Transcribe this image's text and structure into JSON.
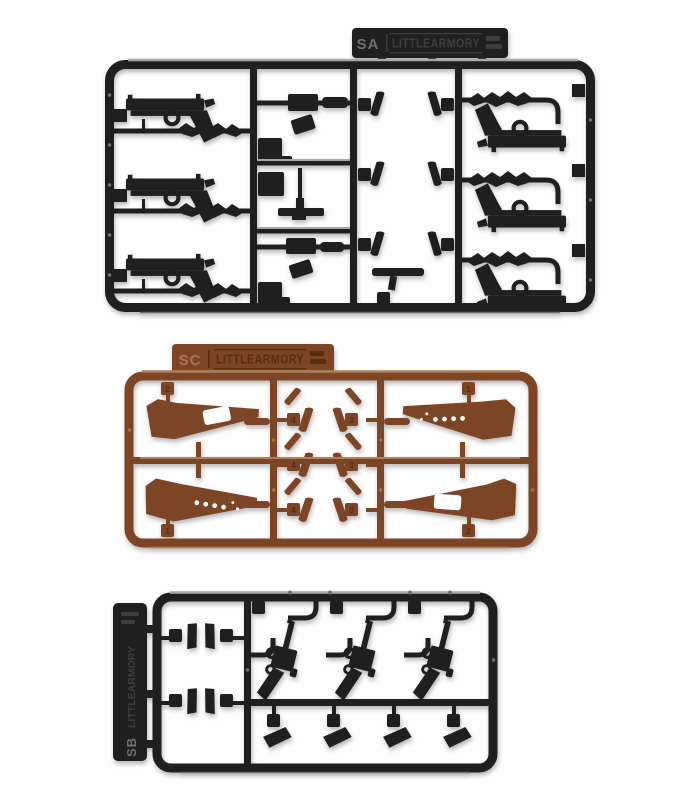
{
  "photo": {
    "background": "#fefefe",
    "subject": "Three plastic model kit part sprues photographed on a white background"
  },
  "colors": {
    "black_plastic": "#1f1f1f",
    "black_highlight": "#a8a8a8",
    "black_soft_highlight": "#6e6e6e",
    "black_emboss": "#3d3d3d",
    "black_emboss_bright": "#6f6f6f",
    "brown_plastic": "#7c4526",
    "brown_highlight": "#b08059",
    "brown_emboss_dark": "#592c12",
    "brown_emboss_light": "#a97a57",
    "pin_dot_black": "#707070",
    "pin_dot_brown": "#a3714e",
    "white_cutout": "#ffffff"
  },
  "sprues": {
    "sa": {
      "tag_label": "SA",
      "logo_text": "LITTLEARMORY"
    },
    "sc": {
      "tag_label": "SC",
      "logo_text": "LITTLEARMORY",
      "part_numbers": {
        "left_top": "2",
        "left_bottom": "1",
        "right_top": "1",
        "right_bottom": "2",
        "mid_left": "4",
        "mid_right": "3"
      }
    },
    "sb": {
      "tag_label": "SB",
      "logo_text": "LITTLEARMORY"
    }
  }
}
